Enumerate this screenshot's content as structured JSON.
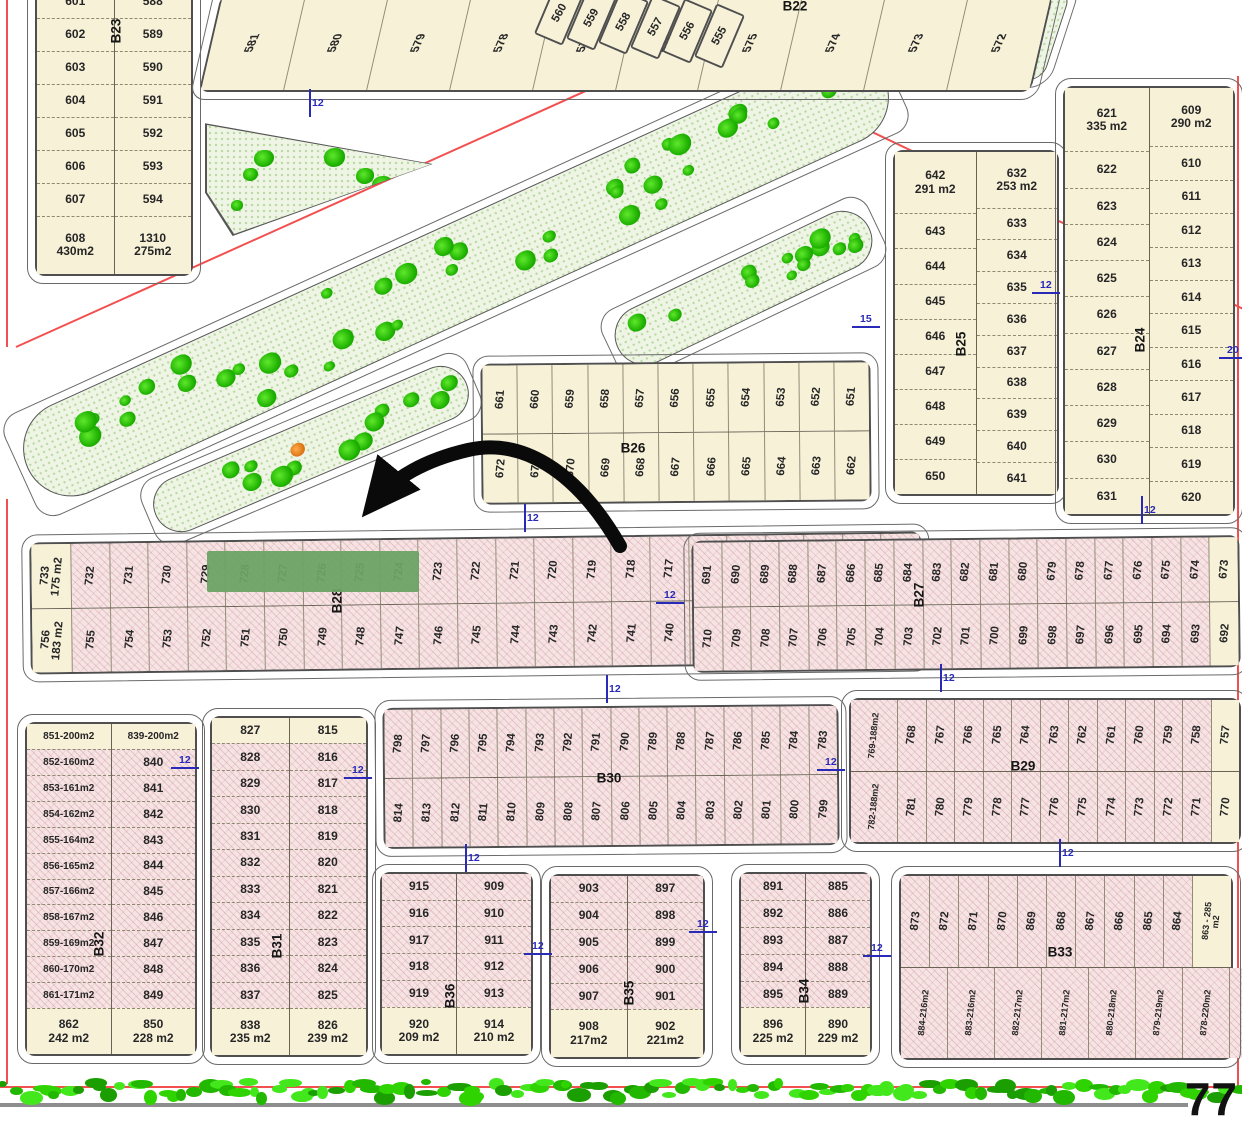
{
  "canvas": {
    "w": 1242,
    "h": 1124
  },
  "palette": {
    "cream": "#f7f1d8",
    "pink": "#f6e4e5",
    "outline": "#4f4f4f",
    "red_line": "#f25050",
    "blue_dim": "#2a2ab8",
    "tree_green": "#1db000",
    "highlight_green": "#6ca365",
    "arrow": "#0a0a0a"
  },
  "annotations": {
    "street_number_label": "77"
  },
  "highlight": {
    "x": 207,
    "y": 551,
    "w": 212,
    "h": 41,
    "color": "rgba(108,163,101,0.95)"
  },
  "blocks": [
    {
      "id": "B23",
      "kind": "cols",
      "x": 35,
      "y": -16,
      "w": 158,
      "h": 292,
      "rot": 0,
      "fill": "cream",
      "label": "B23",
      "lx": 116,
      "ly": 31,
      "lrot": -90,
      "cols": [
        [
          "601",
          "602",
          "603",
          "604",
          "605",
          "606",
          "607",
          {
            "t": "608\n430m2"
          }
        ],
        [
          "588",
          "589",
          "590",
          "591",
          "592",
          "593",
          "594",
          {
            "t": "1310\n275m2"
          }
        ]
      ]
    },
    {
      "id": "B22",
      "kind": "rows",
      "x": 210,
      "y": -6,
      "w": 832,
      "h": 98,
      "rot": 0,
      "skew": -13,
      "fill": "cream",
      "label": "B22",
      "lx": 795,
      "ly": 6,
      "lrot": 0,
      "trot": -78,
      "tskew": 13,
      "rows": [
        [
          "581",
          "580",
          "579",
          "578",
          "577",
          "576",
          "575",
          "574",
          "573",
          "572"
        ]
      ]
    },
    {
      "id": "B25",
      "kind": "cols",
      "x": 893,
      "y": 150,
      "w": 166,
      "h": 346,
      "rot": 0,
      "fill": "cream",
      "label": "B25",
      "lx": 961,
      "ly": 344,
      "lrot": -90,
      "cols": [
        [
          {
            "t": "642\n291 m2"
          },
          "643",
          "644",
          "645",
          "646",
          "647",
          "648",
          "649",
          "650"
        ],
        [
          {
            "t": "632\n253 m2"
          },
          "633",
          "634",
          "635",
          "636",
          "637",
          "638",
          "639",
          "640",
          "641"
        ]
      ]
    },
    {
      "id": "B24",
      "kind": "cols",
      "x": 1063,
      "y": 86,
      "w": 172,
      "h": 430,
      "rot": 0,
      "fill": "cream",
      "label": "B24",
      "lx": 1140,
      "ly": 340,
      "lrot": -90,
      "cols": [
        [
          {
            "t": "621\n335 m2"
          },
          "622",
          "623",
          "624",
          "625",
          "626",
          "627",
          "628",
          "629",
          "630",
          "631"
        ],
        [
          {
            "t": "609\n290 m2"
          },
          "610",
          "611",
          "612",
          "613",
          "614",
          "615",
          "616",
          "617",
          "618",
          "619",
          "620"
        ]
      ]
    },
    {
      "id": "B26",
      "kind": "rows",
      "x": 481,
      "y": 362,
      "w": 390,
      "h": 141,
      "rot": -0.5,
      "fill": "cream",
      "label": "B26",
      "lx": 633,
      "ly": 448,
      "lrot": 0,
      "rows": [
        [
          "661",
          "660",
          "659",
          "658",
          "657",
          "656",
          "655",
          "654",
          "653",
          "652",
          "651"
        ],
        [
          "672",
          "671",
          "670",
          "669",
          "668",
          "667",
          "666",
          "665",
          "664",
          "663",
          "662"
        ]
      ]
    },
    {
      "id": "B28",
      "kind": "rows",
      "x": 30,
      "y": 537,
      "w": 892,
      "h": 132,
      "rot": -0.7,
      "fill": "pink",
      "label": "B28",
      "lx": 337,
      "ly": 601,
      "lrot": -90,
      "rows": [
        [
          {
            "t": "733\n175 m2",
            "f": "cream"
          },
          "732",
          "731",
          "730",
          "729",
          "728",
          "727",
          "726",
          "725",
          "724",
          "723",
          "722",
          "721",
          "720",
          "719",
          "718",
          "717",
          "716",
          "715",
          "714",
          "713",
          "712",
          "711"
        ],
        [
          {
            "t": "756\n183 m2",
            "f": "cream"
          },
          "755",
          "754",
          "753",
          "752",
          "751",
          "750",
          "749",
          "748",
          "747",
          "746",
          "745",
          "744",
          "743",
          "742",
          "741",
          "740",
          "739",
          "738",
          "737",
          "736",
          "735",
          "734"
        ]
      ]
    },
    {
      "id": "B27",
      "kind": "rows",
      "x": 692,
      "y": 538,
      "w": 548,
      "h": 132,
      "rot": -0.6,
      "fill": "pink",
      "label": "B27",
      "lx": 919,
      "ly": 595,
      "lrot": -90,
      "rows": [
        [
          "691",
          "690",
          "689",
          "688",
          "687",
          "686",
          "685",
          "684",
          "683",
          "682",
          "681",
          "680",
          "679",
          "678",
          "677",
          "676",
          "675",
          "674",
          {
            "t": "673",
            "f": "cream"
          }
        ],
        [
          "710",
          "709",
          "708",
          "707",
          "706",
          "705",
          "704",
          "703",
          "702",
          "701",
          "700",
          "699",
          "698",
          "697",
          "696",
          "695",
          "694",
          "693",
          {
            "t": "692",
            "f": "cream"
          }
        ]
      ]
    },
    {
      "id": "B30",
      "kind": "rows",
      "x": 383,
      "y": 706,
      "w": 456,
      "h": 141,
      "rot": -0.5,
      "fill": "pink",
      "label": "B30",
      "lx": 609,
      "ly": 778,
      "lrot": 0,
      "rows": [
        [
          "798",
          "797",
          "796",
          "795",
          "794",
          "793",
          "792",
          "791",
          "790",
          "789",
          "788",
          "787",
          "786",
          "785",
          "784",
          "783"
        ],
        [
          "814",
          "813",
          "812",
          "811",
          "810",
          "809",
          "808",
          "807",
          "806",
          "805",
          "804",
          "803",
          "802",
          "801",
          "800",
          "799"
        ]
      ]
    },
    {
      "id": "B29",
      "kind": "rows",
      "x": 849,
      "y": 698,
      "w": 392,
      "h": 146,
      "rot": 0,
      "fill": "pink",
      "label": "B29",
      "lx": 1023,
      "ly": 766,
      "lrot": 0,
      "rows": [
        [
          "769-188m2",
          "768",
          "767",
          "766",
          "765",
          "764",
          "763",
          "762",
          "761",
          "760",
          "759",
          "758",
          {
            "t": "757",
            "f": "cream"
          }
        ],
        [
          "782-188m2",
          "781",
          "780",
          "779",
          "778",
          "777",
          "776",
          "775",
          "774",
          "773",
          "772",
          "771",
          {
            "t": "770",
            "f": "cream"
          }
        ]
      ]
    },
    {
      "id": "B32",
      "kind": "cols",
      "x": 25,
      "y": 722,
      "w": 172,
      "h": 334,
      "rot": 0,
      "fill": "pink",
      "label": "B32",
      "lx": 99,
      "ly": 944,
      "lrot": -90,
      "cols": [
        [
          {
            "t": "851-200m2",
            "f": "cream"
          },
          "852-160m2",
          "853-161m2",
          "854-162m2",
          "855-164m2",
          "856-165m2",
          "857-166m2",
          "858-167m2",
          "859-169m2",
          "860-170m2",
          "861-171m2",
          {
            "t": "862\n242 m2",
            "f": "cream"
          }
        ],
        [
          {
            "t": "839-200m2",
            "f": "cream"
          },
          "840",
          "841",
          "842",
          "843",
          "844",
          "845",
          "846",
          "847",
          "848",
          "849",
          {
            "t": "850\n228 m2",
            "f": "cream"
          }
        ]
      ]
    },
    {
      "id": "B31",
      "kind": "cols",
      "x": 210,
      "y": 716,
      "w": 158,
      "h": 341,
      "rot": 0,
      "fill": "pink",
      "label": "B31",
      "lx": 277,
      "ly": 946,
      "lrot": -90,
      "cols": [
        [
          {
            "t": "827",
            "f": "cream"
          },
          "828",
          "829",
          "830",
          "831",
          "832",
          "833",
          "834",
          "835",
          "836",
          "837",
          {
            "t": "838\n235 m2",
            "f": "cream"
          }
        ],
        [
          {
            "t": "815",
            "f": "cream"
          },
          "816",
          "817",
          "818",
          "819",
          "820",
          "821",
          "822",
          "823",
          "824",
          "825",
          {
            "t": "826\n239 m2",
            "f": "cream"
          }
        ]
      ]
    },
    {
      "id": "B36",
      "kind": "cols",
      "x": 380,
      "y": 872,
      "w": 153,
      "h": 184,
      "rot": 0,
      "fill": "pink",
      "label": "B36",
      "lx": 450,
      "ly": 996,
      "lrot": -90,
      "cols": [
        [
          "915",
          "916",
          "917",
          "918",
          "919",
          {
            "t": "920\n209 m2",
            "f": "cream"
          }
        ],
        [
          "909",
          "910",
          "911",
          "912",
          "913",
          {
            "t": "914\n210 m2",
            "f": "cream"
          }
        ]
      ]
    },
    {
      "id": "B35",
      "kind": "cols",
      "x": 549,
      "y": 874,
      "w": 156,
      "h": 185,
      "rot": 0,
      "fill": "pink",
      "label": "B35",
      "lx": 629,
      "ly": 993,
      "lrot": -90,
      "cols": [
        [
          "903",
          "904",
          "905",
          "906",
          "907",
          {
            "t": "908\n217m2",
            "f": "cream"
          }
        ],
        [
          "897",
          "898",
          "899",
          "900",
          "901",
          {
            "t": "902\n221m2",
            "f": "cream"
          }
        ]
      ]
    },
    {
      "id": "B34",
      "kind": "cols",
      "x": 739,
      "y": 872,
      "w": 133,
      "h": 185,
      "rot": 0,
      "fill": "pink",
      "label": "B34",
      "lx": 804,
      "ly": 991,
      "lrot": -90,
      "cols": [
        [
          "891",
          "892",
          "893",
          "894",
          "895",
          {
            "t": "896\n225 m2",
            "f": "cream"
          }
        ],
        [
          "885",
          "886",
          "887",
          "888",
          "889",
          {
            "t": "890\n229 m2",
            "f": "cream"
          }
        ]
      ]
    },
    {
      "id": "B33",
      "kind": "rows",
      "x": 899,
      "y": 874,
      "w": 334,
      "h": 186,
      "rot": 0,
      "fill": "pink",
      "label": "B33",
      "lx": 1060,
      "ly": 952,
      "lrot": 0,
      "rows": [
        [
          "873",
          "872",
          "871",
          "870",
          "869",
          "868",
          "867",
          "866",
          "865",
          "864",
          {
            "t": "863 - 285\nm2",
            "f": "cream"
          }
        ],
        [
          "884-216m2",
          "883-216m2",
          "882-217m2",
          "881-217m2",
          "880-218m2",
          "879-219m2",
          "878-220m2",
          "877-220m2",
          "876-221m2",
          "875 - 222 m2",
          {
            "t": "874-318m2",
            "f": "cream"
          }
        ]
      ]
    }
  ],
  "stairs": {
    "x": 544,
    "y": -16,
    "dx": 32,
    "dy": 4.5,
    "w": 31,
    "h": 58,
    "rot": 23,
    "plots": [
      "560",
      "559",
      "558",
      "557",
      "556",
      "555"
    ]
  },
  "parks": [
    {
      "name": "park-top-right",
      "x": 905,
      "y": -8,
      "w": 150,
      "h": 86,
      "rot": 0,
      "skew": -18,
      "r": 14,
      "trees": 12
    },
    {
      "name": "park-strip-long",
      "x": -15,
      "y": 225,
      "w": 940,
      "h": 94,
      "rot": -24.5,
      "r": 48,
      "trees": 42
    },
    {
      "name": "park-strip-small",
      "x": 142,
      "y": 421,
      "w": 336,
      "h": 54,
      "rot": -23,
      "r": 28,
      "trees": 12,
      "accent": true
    },
    {
      "name": "park-wedge-right",
      "x": 604,
      "y": 258,
      "w": 277,
      "h": 58,
      "rot": -25.5,
      "r": 30,
      "trees": 13
    }
  ],
  "triangle_park": {
    "name": "park-triangle-left",
    "x": 205,
    "y": 116,
    "w": 230,
    "h": 120,
    "clip": "polygon(0 6%, 99% 40%, 12% 100%, 0 64%)",
    "trees": 10
  },
  "red_lines": [
    {
      "x": 7,
      "y": -2,
      "len": 348,
      "rot": 90
    },
    {
      "x": 16,
      "y": 346,
      "len": 865,
      "rot": -24.2
    },
    {
      "x": 652,
      "y": 26,
      "len": 655,
      "rot": 25.5
    },
    {
      "x": 1238,
      "y": 75,
      "len": 1010,
      "rot": 90
    },
    {
      "x": 7,
      "y": 498,
      "len": 585,
      "rot": 90
    },
    {
      "x": 0,
      "y": 1086,
      "len": 1242,
      "rot": 0
    }
  ],
  "dimensions": [
    {
      "x": 309,
      "y": 103,
      "o": "v",
      "t": "12"
    },
    {
      "x": 866,
      "y": 326,
      "o": "h",
      "t": "15"
    },
    {
      "x": 1046,
      "y": 292,
      "o": "h",
      "t": "12"
    },
    {
      "x": 1233,
      "y": 357,
      "o": "h",
      "t": "20"
    },
    {
      "x": 1141,
      "y": 510,
      "o": "v",
      "t": "12"
    },
    {
      "x": 524,
      "y": 518,
      "o": "v",
      "t": "12"
    },
    {
      "x": 670,
      "y": 602,
      "o": "h",
      "t": "12"
    },
    {
      "x": 606,
      "y": 689,
      "o": "v",
      "t": "12"
    },
    {
      "x": 940,
      "y": 678,
      "o": "v",
      "t": "12"
    },
    {
      "x": 185,
      "y": 767,
      "o": "h",
      "t": "12"
    },
    {
      "x": 358,
      "y": 777,
      "o": "h",
      "t": "12"
    },
    {
      "x": 831,
      "y": 769,
      "o": "h",
      "t": "12"
    },
    {
      "x": 465,
      "y": 858,
      "o": "v",
      "t": "12"
    },
    {
      "x": 1059,
      "y": 853,
      "o": "v",
      "t": "12"
    },
    {
      "x": 538,
      "y": 953,
      "o": "h",
      "t": "12"
    },
    {
      "x": 703,
      "y": 931,
      "o": "h",
      "t": "12"
    },
    {
      "x": 877,
      "y": 955,
      "o": "h",
      "t": "12"
    }
  ],
  "hedge": {
    "y": 1084,
    "count": 120
  }
}
